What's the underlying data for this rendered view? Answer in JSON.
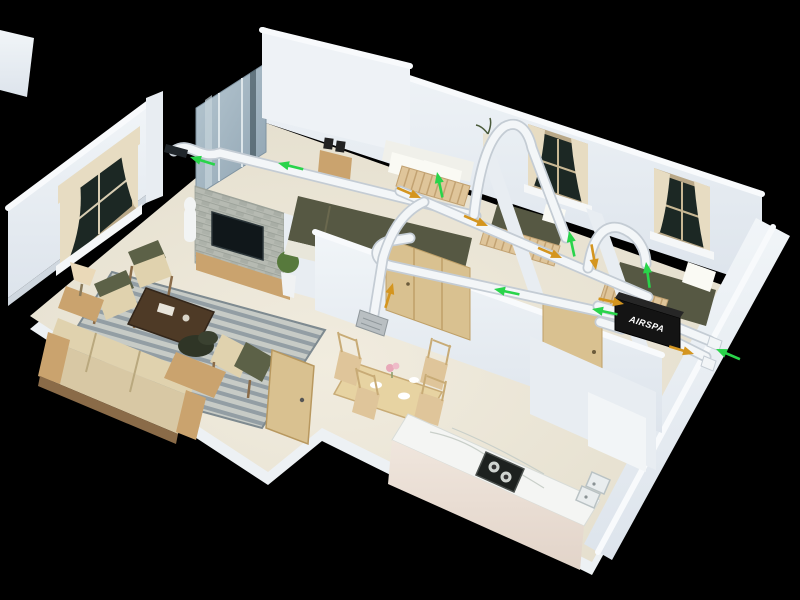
{
  "scene": {
    "background": "#000000"
  },
  "ventilation": {
    "unit_brand": "AIRSPA",
    "supply_airflow_color": "#29d44a",
    "return_airflow_color": "#d4951f",
    "duct_color": "#f3f6f8",
    "arrows": [
      {
        "kind": "supply",
        "x": 190,
        "y": 157,
        "angle": 197
      },
      {
        "kind": "supply",
        "x": 278,
        "y": 163,
        "angle": 194
      },
      {
        "kind": "supply",
        "x": 437,
        "y": 172,
        "angle": 258
      },
      {
        "kind": "supply",
        "x": 494,
        "y": 289,
        "angle": 192
      },
      {
        "kind": "supply",
        "x": 569,
        "y": 231,
        "angle": 258
      },
      {
        "kind": "supply",
        "x": 646,
        "y": 262,
        "angle": 262
      },
      {
        "kind": "supply",
        "x": 592,
        "y": 309,
        "angle": 192
      },
      {
        "kind": "supply",
        "x": 716,
        "y": 349,
        "angle": 203
      },
      {
        "kind": "return",
        "x": 421,
        "y": 198,
        "angle": 23
      },
      {
        "kind": "return",
        "x": 488,
        "y": 226,
        "angle": 23
      },
      {
        "kind": "return",
        "x": 562,
        "y": 258,
        "angle": 23
      },
      {
        "kind": "return",
        "x": 393,
        "y": 283,
        "angle": 287
      },
      {
        "kind": "return",
        "x": 596,
        "y": 270,
        "angle": 80
      },
      {
        "kind": "return",
        "x": 624,
        "y": 304,
        "angle": 12
      },
      {
        "kind": "return",
        "x": 694,
        "y": 354,
        "angle": 17
      }
    ]
  },
  "palette": {
    "bg": "#000000",
    "wall": "#e8edf2",
    "wall-shadow": "#cfd7df",
    "wall-top": "#f8fafc",
    "floor": "#e9e4d5",
    "slab": "#edf1f4",
    "rug-a": "#c7cbc6",
    "rug-b": "#939ea4",
    "wood": "#caa36e",
    "wood-light": "#dfc59a",
    "wood-dark": "#4e3a26",
    "sofa-cream": "#e0d2ae",
    "cushion-olive": "#5c6147",
    "bed-olive": "#565843",
    "glass": "#9fb4c2",
    "stone": "#b6bab2",
    "duct": "#f3f6f8",
    "duct-edge": "#c4ccd4",
    "unit-black": "#141414",
    "pane-dark": "#1c2824",
    "curtain": "#e7dcc2",
    "counter-top": "#f4f5f3",
    "counter-face": "#eadfd6",
    "tv-black": "#10171a",
    "plant-green": "#57793c"
  }
}
